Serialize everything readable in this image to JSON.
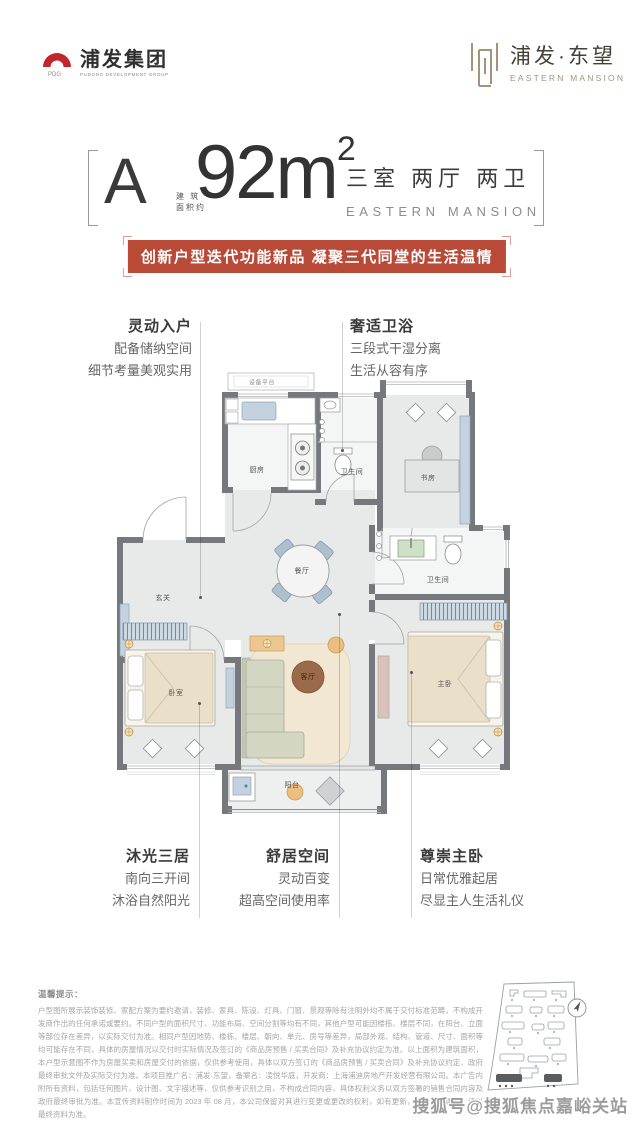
{
  "header": {
    "group_logo": {
      "title": "浦发集团",
      "subtitle": "PUDONG DEVELOPMENT GROUP"
    },
    "brand_logo": {
      "title": "浦发·东望",
      "subtitle": "EASTERN MANSION"
    }
  },
  "title_block": {
    "unit_letter": "A",
    "area_note_line1": "建 筑",
    "area_note_line2": "面积约",
    "area_value": "92m",
    "area_superscript": "2",
    "layout_cn": "三室 两厅 两卫",
    "layout_en": "EASTERN MANSION"
  },
  "banner": {
    "text": "创新户型迭代功能新品 凝聚三代同堂的生活温情"
  },
  "callouts": [
    {
      "title": "灵动入户",
      "line1": "配备储纳空间",
      "line2": "细节考量美观实用"
    },
    {
      "title": "奢适卫浴",
      "line1": "三段式干湿分离",
      "line2": "生活从容有序"
    },
    {
      "title": "沐光三居",
      "line1": "南向三开间",
      "line2": "沐浴自然阳光"
    },
    {
      "title": "舒居空间",
      "line1": "灵动百变",
      "line2": "超高空间使用率"
    },
    {
      "title": "尊崇主卧",
      "line1": "日常优雅起居",
      "line2": "尽显主人生活礼仪"
    }
  ],
  "floorplan": {
    "rooms": {
      "equipment_platform": "设备平台",
      "kitchen": "厨房",
      "bathroom1": "卫生间",
      "study": "书房",
      "foyer": "玄关",
      "dining": "餐厅",
      "bathroom2": "卫生间",
      "bedroom": "卧室",
      "living": "客厅",
      "master_bedroom": "主卧",
      "balcony": "阳台"
    }
  },
  "disclaimer": {
    "title": "温馨提示：",
    "body": "户型图所展示装饰装修、家配方案为要约邀请，装修、家具、陈设、灯具、门窗、景观等除有注明外均不属于交付标准范畴，不构成开发商作出的任何承诺或要约。不同户型的面积尺寸、功能布局、空间分割等均有不同，其他户型可能因楼栋、楼层不同，在阳台、立面等部位存在差异，以实际交付为准。相同户型因地势、楼栋、楼层、朝向、单元、房号等差异，局部外观、结构、管道、尺寸、面积等均可能存在不同，具体的房屋情况以交付时实际情况及签订的《商品房预售 / 买卖合同》及补充协议约定为准。以上面积为建筑面积，本户型示意图不作为房屋买卖和房屋交付的依据，仅供参考使用，具体以双方签订的《商品房预售 / 买卖合同》及补充协议约定、政府最终审批文件及实际交付为准。本项目推广名：浦发·东望，备案名：凌悦华庭，开发商：上海浦迪房地产开发经营有限公司。本广告内附所有资料，包括任何图片、设计图、文字描述等，仅供参考识别之用，不构成合同内容，具体权利义务以双方签署的销售合同内容及政府最终审批为准。本宣传资料制作时间为 2023 年 08 月，本公司保留对其进行变更或更改的权利，如有更新，恕不另行通知，请以最终资料为准。"
  },
  "watermark": "搜狐号@搜狐焦点嘉峪关站",
  "colors": {
    "banner_red": "#b94a38",
    "logo_red": "#c0272d",
    "brand_bronze": "#a5927a",
    "wall_gray": "#75787d",
    "accent_blue": "#c3d2de",
    "accent_beige": "#eadfc9",
    "accent_brown": "#9b6b49",
    "accent_tan": "#ecbe82"
  }
}
